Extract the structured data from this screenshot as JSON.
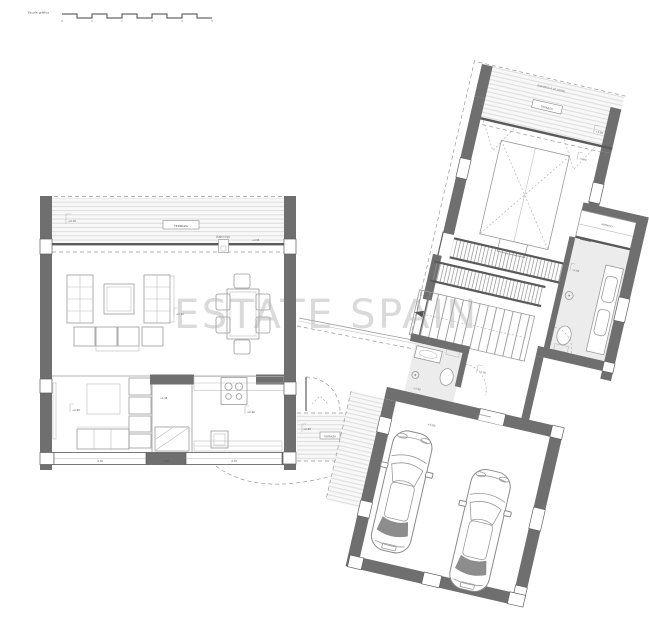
{
  "watermark": {
    "text": "ESTATE SPAIN"
  },
  "scale_bar": {
    "label": "Escala gráfica",
    "ticks": [
      "0",
      "1",
      "2",
      "3",
      "4",
      "5"
    ]
  },
  "left_wing": {
    "terrace_label": "TERRAZA",
    "terrace_level": "+4.76",
    "terrace_note": "+4.96",
    "fixed_point_label": "PUNTO FIJO",
    "living_level": "+2.90",
    "study_level": "+2.90",
    "hall_level": "+1.98",
    "kitchen_level": "+2.90",
    "dims": [
      "4.70",
      "1.90",
      "4.70"
    ]
  },
  "walkway": {
    "label": "TERRAZA",
    "level": "+2.90"
  },
  "right_wing": {
    "terrace_label": "TERRAZA",
    "terrace_note": "BARANDILLA DE VIDRIO",
    "terrace_level": "+4.90",
    "room_level": "+4.90",
    "closet_label": "ARMARIO",
    "bath_level": "+4.90",
    "wc_level": "+2.90",
    "hall_level": "+2.90",
    "garage_level": "+0.00"
  }
}
